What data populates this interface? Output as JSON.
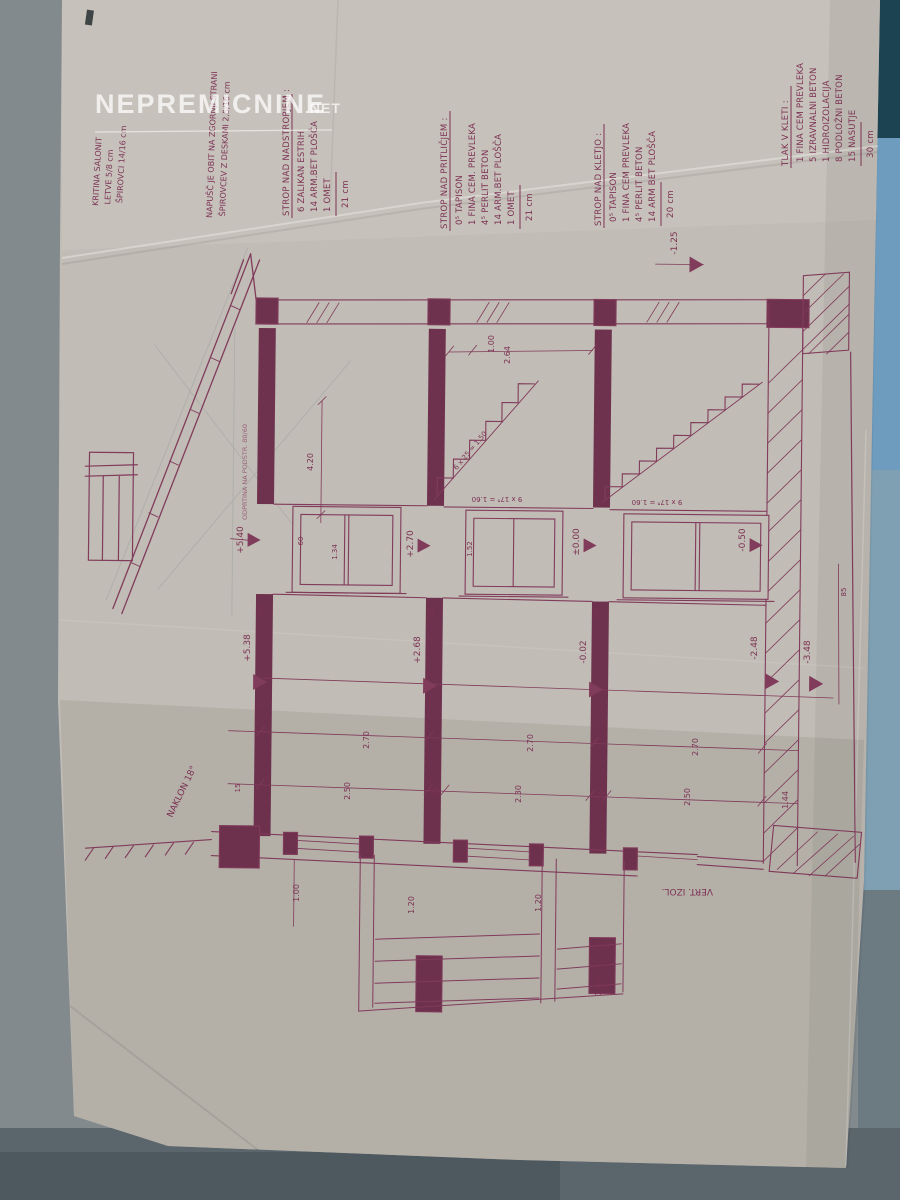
{
  "watermark": {
    "name": "NEPREMICNINE",
    "tld": ".NET"
  },
  "colors": {
    "ink": "#7c3154",
    "paper": "#c1bcb5",
    "desk_blue": "#6d9cbe",
    "desk_teal": "#1c4352",
    "desk_gray": "#828a8e"
  },
  "notes": {
    "kritina": {
      "lines": [
        "KRITINA SALONIT",
        "LETVE 5/8 cm",
        "ŠPIROVCI 14/16 cm"
      ]
    },
    "napusc": {
      "lines": [
        "NAPUŠČ JE OBIT NA ZGORNJI STRANI",
        "ŠPIROVCEV Z DESKAMI 2,5/16 cm"
      ]
    },
    "strop_nadstropjem": {
      "title": "STROP NAD NADSTROPJEM :",
      "lines": [
        "6 ZALIKAN ESTRIH",
        "14 ARM.BET PLOŠČA",
        "1 OMET"
      ],
      "total": "21 cm"
    },
    "strop_pritlicjem": {
      "title": "STROP NAD PRITLIČJEM :",
      "lines": [
        "0⁵ TAPISON",
        "1 FINA CEM. PREVLEKA",
        "4⁵ PERLIT BETON",
        "14 ARM.BET PLOŠČA",
        "1 OMET"
      ],
      "total": "21 cm"
    },
    "strop_kletjo": {
      "title": "STROP NAD KLETJO :",
      "lines": [
        "0⁵ TAPISON",
        "1 FINA CEM PREVLEKA",
        "4⁵ PERLIT BETON",
        "14 ARM BET PLOŠČA"
      ],
      "total": "20 cm"
    },
    "tlak_kleti": {
      "title": "TLAK V KLETI :",
      "lines": [
        "1 FINA CEM PREVLEKA",
        "5 IZRAVNALNI BETON",
        "1 HIDROIZOLACIJA",
        "8 PODLOŽNI BETON",
        "15 NASUTJE"
      ],
      "total": "30 cm"
    }
  },
  "labels": {
    "naklon": "NAKLON 18°",
    "vert_izol": "VERT. IZOL.",
    "odprtina": "ODPRTINA NA PODSTR. 80/60",
    "stair_run": "6 x 25 = 1.50",
    "stair_calc_a": "9 x 17⁸ = 1.60",
    "stair_calc_b": "9 x 17⁸ = 1.60"
  },
  "elevations": {
    "sill_attic": "+5.40",
    "sill_first": "+2.70",
    "sill_ground": "±0.00",
    "sill_basement": "-0.50",
    "floor_attic": "+5.38",
    "floor_first": "+2.68",
    "floor_ground": "-0.02",
    "floor_basement": "-2.48",
    "foundation": "-3.48",
    "terrain": "-1.25"
  },
  "dims": {
    "roof_run": "4.20",
    "sill_h": "60",
    "win_h1": "1.34",
    "win_h2": "1.52",
    "top_a": "1.00",
    "top_b": "2.64",
    "story_1": "2.70",
    "story_2": "2.70",
    "story_3": "2.70",
    "clear_1": "2.50",
    "clear_2": "2.30",
    "clear_3": "2.50",
    "slab_a": "20",
    "slab_b": "20",
    "slab_c": "20",
    "slab_d": "20",
    "slab_e": "20",
    "found_h": "1.44",
    "base_t": "15",
    "wall_t": "85",
    "stair_a": "1.00",
    "stair_b": "1.20",
    "stair_c": "1.20",
    "stair_d": "1.00"
  }
}
